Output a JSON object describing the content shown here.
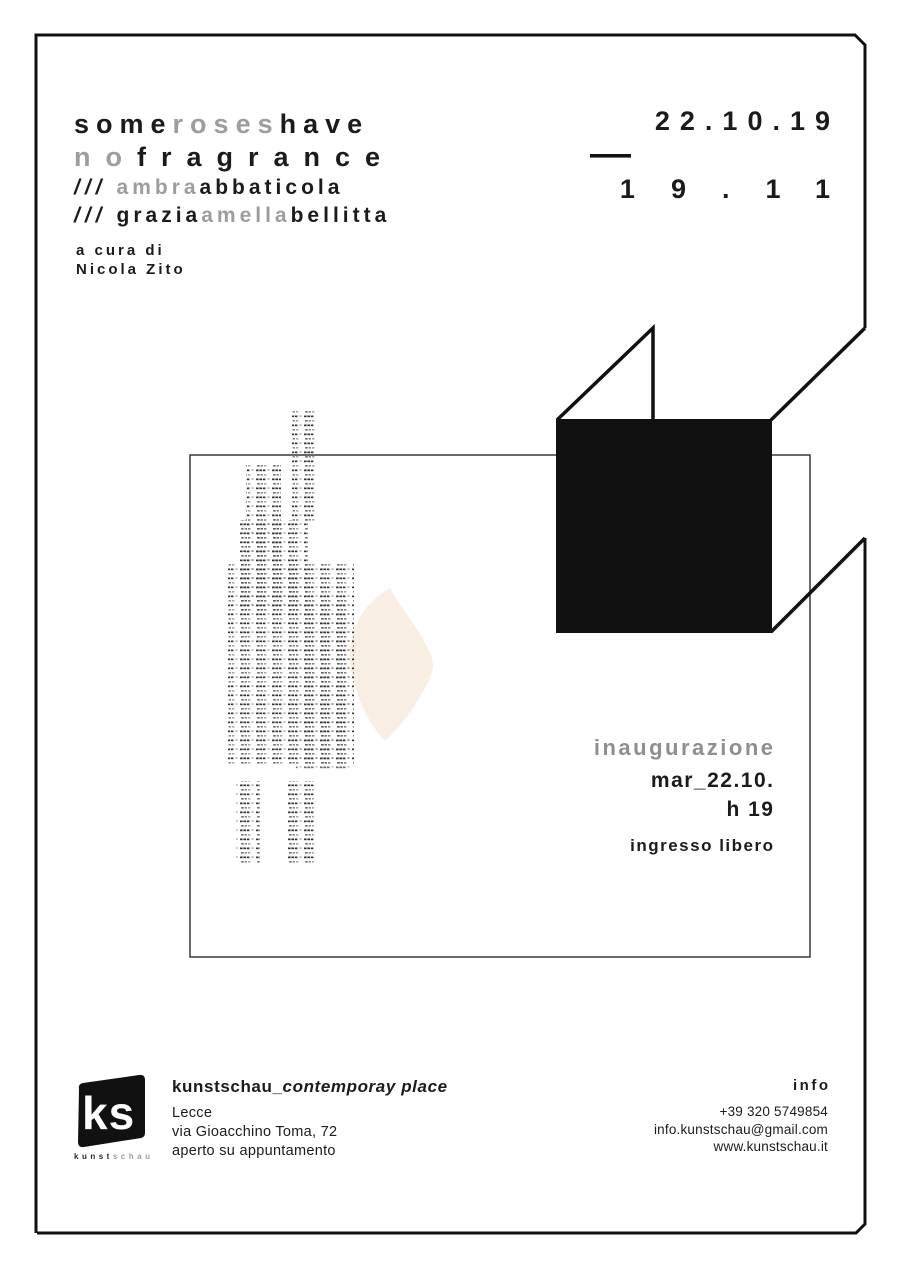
{
  "colors": {
    "ink": "#1b1b1b",
    "muted_gray": "#9d9d9d",
    "event_label_gray": "#8f8f8f",
    "blob_peach": "#f8eee4",
    "frame_black": "#111111"
  },
  "title": {
    "line1": [
      {
        "t": "some",
        "c": "ink"
      },
      {
        "t": "roses",
        "c": "gray"
      },
      {
        "t": "have",
        "c": "ink"
      }
    ],
    "line2": [
      {
        "t": "no",
        "c": "gray"
      },
      {
        "t": "fragrance",
        "c": "ink"
      }
    ]
  },
  "artists": [
    {
      "slashes": "///",
      "words": [
        {
          "t": "ambra",
          "c": "gray"
        },
        {
          "t": "abbaticola",
          "c": "ink"
        }
      ]
    },
    {
      "slashes": "///",
      "words": [
        {
          "t": "grazia",
          "c": "ink"
        },
        {
          "t": "amella",
          "c": "gray"
        },
        {
          "t": "bellitta",
          "c": "ink"
        }
      ]
    }
  ],
  "curator": {
    "line1": "a cura di",
    "line2": "Nicola Zito"
  },
  "dates": {
    "start": "22.10.19",
    "end": "19.11"
  },
  "event": {
    "label": "inaugurazione",
    "date": "mar_22.10.",
    "time": "h 19",
    "admission": "ingresso libero"
  },
  "logo": {
    "mark": "ks",
    "caption_dark": "kunst",
    "caption_light": "schau"
  },
  "venue": {
    "name_bold": "kunstschau_",
    "name_italic": "contemporay place",
    "city": "Lecce",
    "address": "via Gioacchino Toma, 72",
    "note": "aperto su appuntamento"
  },
  "contact": {
    "heading": "info",
    "phone": "+39 320 5749854",
    "email": "info.kunstschau@gmail.com",
    "website": "www.kunstschau.it"
  }
}
